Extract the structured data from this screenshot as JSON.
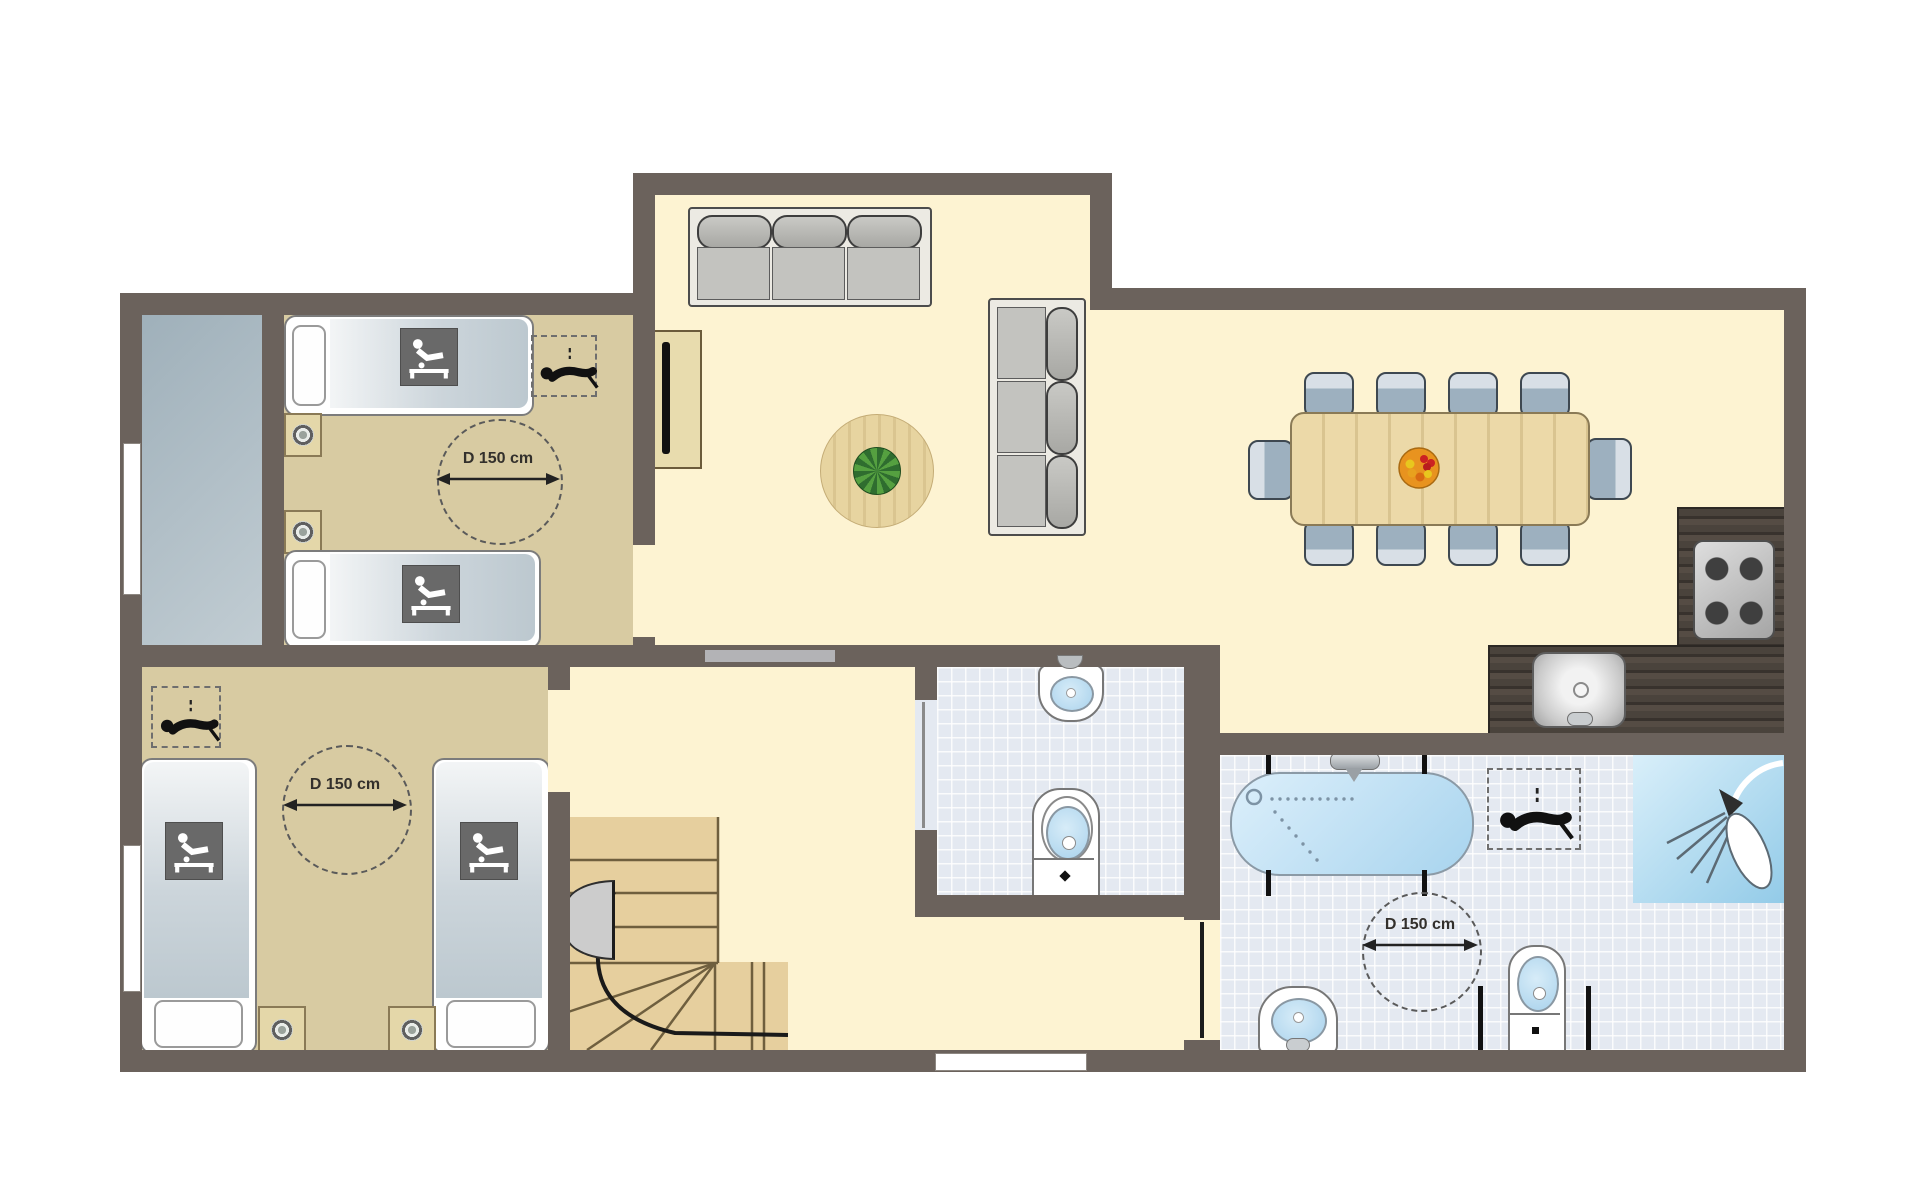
{
  "title": "accessible-holiday-home-floor-plan",
  "labels": {
    "turning_circle": "D 150 cm"
  },
  "colors": {
    "wall": "#6b625c",
    "living_floor": "#fdf3d2",
    "bedroom_floor": "#d8cba2",
    "terrace_floor": "#aebcc4",
    "tile_floor": "#e4e9f1",
    "stairs_wood": "#e6cf9e",
    "counter_wood": "#463f38",
    "bathtub_blue": "#bfdff2",
    "shower_blue": "#a5d3ea",
    "table_wood": "#ecd9a8",
    "sofa_gray": "#c4c4c0",
    "chair_gray": "#9db0bf",
    "accessibility_icon_square": "#696969"
  },
  "icons": [
    {
      "name": "wheelchair-bed-icon",
      "count": 4
    },
    {
      "name": "patient-hoist-icon",
      "count": 3
    },
    {
      "name": "turning-circle-arrow-icon",
      "count": 3
    },
    {
      "name": "shower-head-icon",
      "count": 1
    },
    {
      "name": "plant-icon",
      "count": 1
    },
    {
      "name": "fruit-bowl-icon",
      "count": 1
    },
    {
      "name": "cooktop-burners-icon",
      "count": 1
    }
  ],
  "rooms": [
    {
      "name": "bedroom-top-left",
      "beds": 2,
      "nightstands": 2,
      "turning_circle": true,
      "hoist": true
    },
    {
      "name": "bedroom-bottom-left",
      "beds": 2,
      "nightstands": 2,
      "turning_circle": true,
      "hoist": true
    },
    {
      "name": "terrace",
      "type": "outdoor-gray-area"
    },
    {
      "name": "living-room",
      "furniture": [
        "sofa-3-seat-top",
        "sofa-3-seat-vertical",
        "tv-cabinet",
        "round-rug-with-plant"
      ]
    },
    {
      "name": "dining-area",
      "furniture": [
        "dining-table",
        "chairs-x10",
        "fruit-bowl"
      ]
    },
    {
      "name": "kitchen",
      "furniture": [
        "l-shaped-counter",
        "cooktop-4-burner",
        "kitchen-sink"
      ]
    },
    {
      "name": "toilet-room",
      "fixtures": [
        "washbasin",
        "toilet"
      ]
    },
    {
      "name": "bathroom",
      "fixtures": [
        "bathtub",
        "shower",
        "washbasin",
        "toilet"
      ],
      "turning_circle": true,
      "hoist": true
    },
    {
      "name": "hallway",
      "features": [
        "winder-staircase",
        "door"
      ]
    }
  ]
}
